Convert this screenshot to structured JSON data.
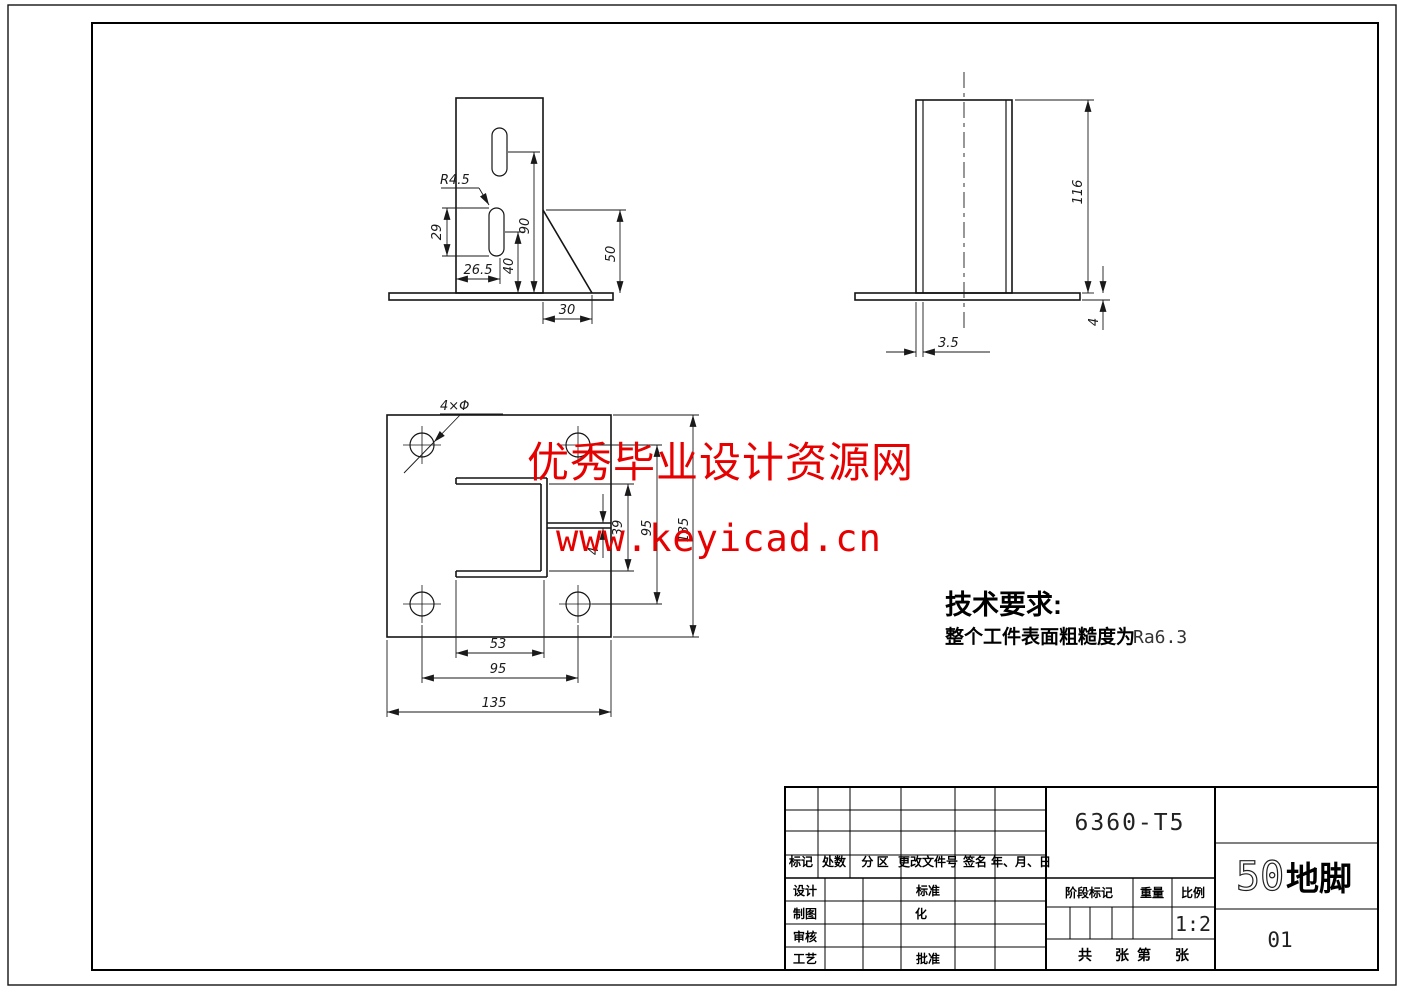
{
  "watermark": {
    "line1": "优秀毕业设计资源网",
    "line2": "www.keyicad.cn",
    "color": "#e60000"
  },
  "tech_requirements": {
    "title": "技术要求:",
    "text_cn": "整个工件表面粗糙度为",
    "text_value": "Ra6.3"
  },
  "views": {
    "front": {
      "dims": {
        "slot_radius": "R4.5",
        "slot_length": "29",
        "slot_offset": "26.5",
        "lower_slot_height": "40",
        "upper_slot_height": "90",
        "gusset_height": "50",
        "gusset_width": "30"
      }
    },
    "side": {
      "dims": {
        "height": "116",
        "base_thickness": "4",
        "wall_thickness": "3.5"
      }
    },
    "top": {
      "dims": {
        "hole_callout": "4×Φ",
        "channel_depth": "53",
        "hole_spacing_x": "95",
        "plate_width": "135",
        "rib_thickness": "4",
        "channel_inner": "39",
        "hole_spacing_y": "95",
        "plate_height": "135"
      }
    }
  },
  "title_block": {
    "drawing_number": "6360-T5",
    "part_name_prefix": "50",
    "part_name": "地脚",
    "sheet_number": "01",
    "scale_value": "1:2",
    "revision_headers": [
      "标记",
      "处数",
      "分 区",
      "更改文件号",
      "签名",
      "年、月、日"
    ],
    "role_labels": [
      "设计",
      "制图",
      "审核",
      "工艺"
    ],
    "mid_labels": {
      "standard_1": "标准",
      "standard_2": "化",
      "approve": "批准"
    },
    "stage_headers": {
      "stage": "阶段标记",
      "weight": "重量",
      "scale": "比例"
    },
    "sheets_words": [
      "共",
      "张",
      "第",
      "张"
    ]
  }
}
